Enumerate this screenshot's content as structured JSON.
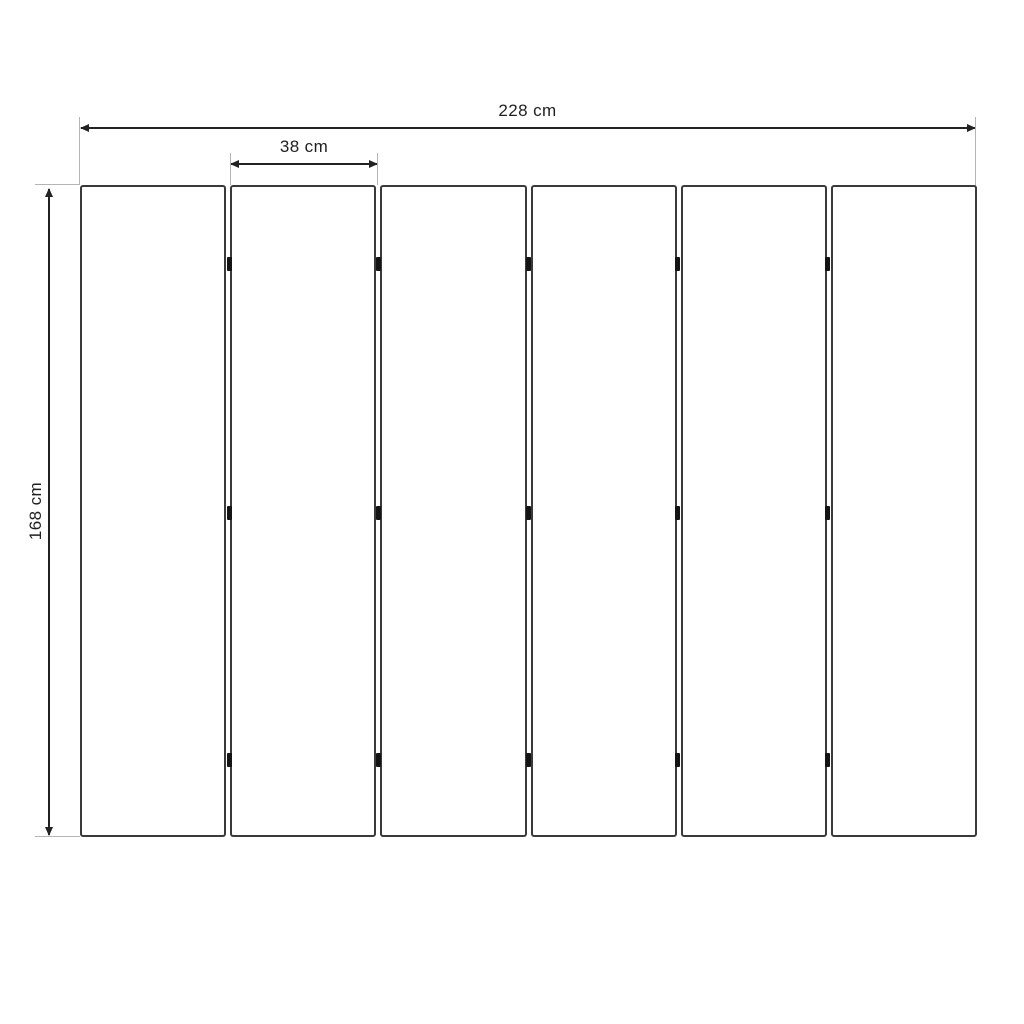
{
  "diagram": {
    "type": "technical-drawing",
    "subject": "folding-screen-panel-layout",
    "panels": {
      "count": 6,
      "hinges_per_gap": 3,
      "hinge_rows_pct": [
        12.1,
        50.3,
        88.2
      ]
    },
    "dimensions": {
      "total_width": {
        "label": "228 cm",
        "value": 228,
        "unit": "cm"
      },
      "panel_width": {
        "label": "38 cm",
        "value": 38,
        "unit": "cm"
      },
      "height": {
        "label": "168 cm",
        "value": 168,
        "unit": "cm"
      }
    },
    "colors": {
      "background": "#ffffff",
      "panel_outline": "#3a3a3a",
      "dimension_line": "#222222",
      "extension_line": "#b4b4b4",
      "hinge": "#141414",
      "text": "#1f1f1f"
    }
  }
}
